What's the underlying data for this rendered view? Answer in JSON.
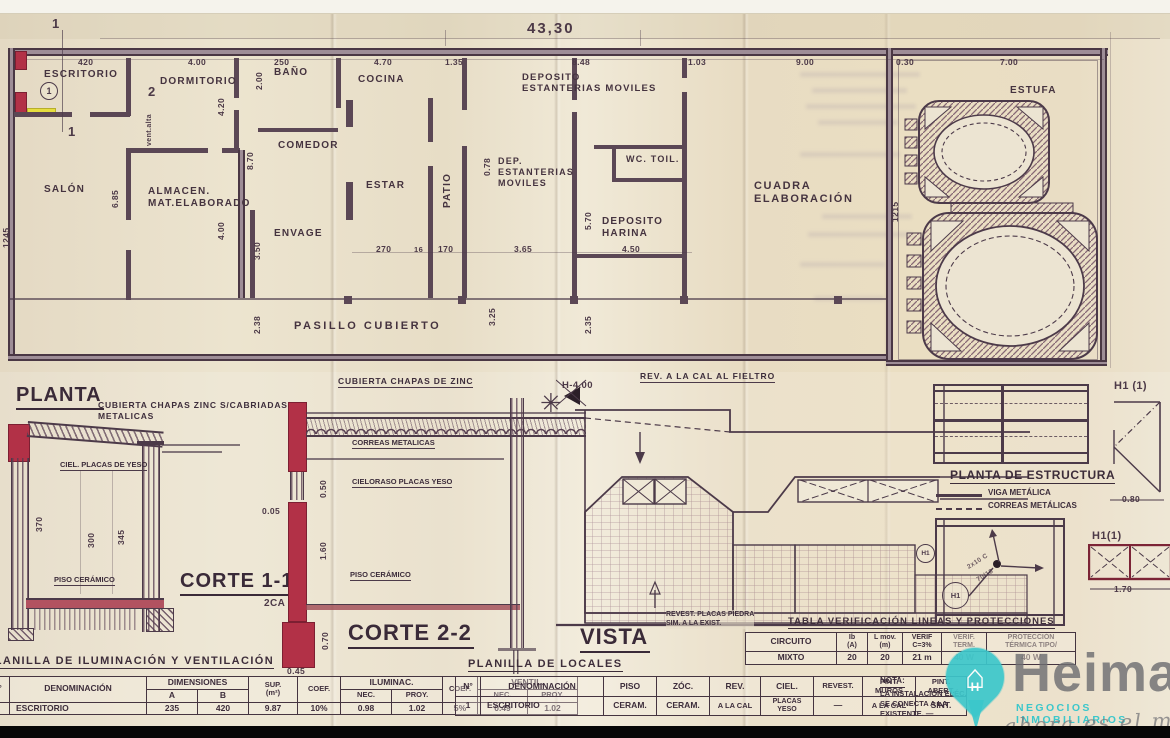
{
  "scan": {
    "overall_width_dim": "43,30"
  },
  "plan": {
    "title": "PLANTA",
    "rooms": {
      "escritorio": "ESCRITORIO",
      "dormitorio": "DORMITORIO",
      "bano": "BAÑO",
      "cocina": "COCINA",
      "salon": "SALÓN",
      "almacen": "ALMACEN.\nMAT.ELABORADO",
      "comedor": "COMEDOR",
      "envage": "ENVAGE",
      "estar": "ESTAR",
      "patio": "PATIO",
      "deposito_estanterias": "DEPOSITO\nESTANTERIAS MOVILES",
      "dep_estanterias": "DEP.\nESTANTERIAS\nMOVILES",
      "wc": "WC.  TOIL.",
      "deposito_harina": "DEPOSITO\nHARINA",
      "cuadra": "CUADRA\nELABORACIÓN",
      "estufa": "ESTUFA",
      "horno_1": "HORNO",
      "horno_2": "HORNO",
      "pasillo": "PASILLO CUBIERTO"
    },
    "dims": {
      "t420": "420",
      "t400": "4.00",
      "t250": "250",
      "t470": "4.70",
      "t135": "1.35",
      "t103": "1.03",
      "t848": "8.48",
      "t900": "9.00",
      "t030": "0.30",
      "t700": "7.00",
      "m270": "270",
      "m16": "16",
      "m170": "170",
      "m365": "3.65",
      "m450": "4.50",
      "v685": "6.85",
      "v420": "4.20",
      "v200": "2.00",
      "v870": "8.70",
      "v400": "4.00",
      "v350": "3.50",
      "v238": "2.38",
      "v078": "0.78",
      "v570": "5.70",
      "v325": "3.25",
      "v235": "2.35",
      "v1215": "1215",
      "v1245": "1245",
      "vent_alta": "vent.alta"
    },
    "marks": {
      "cut1a": "1",
      "cut1b": "1",
      "cut2": "2",
      "circle1": "1"
    }
  },
  "corte1": {
    "title": "CORTE 1-1",
    "cubierta": "CUBIERTA CHAPAS ZINC S/CABRIADAS\nMETALICAS",
    "cielo": "CIEL. PLACAS DE YESO",
    "piso": "PISO CERÁMICO",
    "d370": "370",
    "d300": "300",
    "d345": "345",
    "d005": "0.05",
    "d2ca": "2CA"
  },
  "corte2": {
    "title": "CORTE 2-2",
    "cubierta": "CUBIERTA CHAPAS DE ZINC",
    "correas": "CORREAS METALICAS",
    "cielo": "CIELORASO PLACAS YESO",
    "piso": "PISO CERÁMICO",
    "d050": "0.50",
    "d160": "1.60",
    "d070": "0.70",
    "d045": "0.45"
  },
  "vista": {
    "title": "VISTA",
    "rev": "REV. A LA CAL AL FIELTRO",
    "h": "H-4.00",
    "revest": "REVEST. PLACAS PIEDRA\nSIM. A LA EXIST."
  },
  "estructura": {
    "title": "PLANTA DE ESTRUCTURA",
    "viga": "VIGA METÁLICA",
    "correas": "CORREAS METÁLICAS",
    "h1_top": "H1 (1)",
    "h1_bot": "H1(1)",
    "d080": "0.80",
    "d170": "1.70",
    "h1a": "H1",
    "h1b": "H1",
    "n1": "2x10 C",
    "n2": "70/18"
  },
  "verif": {
    "title": "TABLA VERIFICACIÓN LINEAS Y PROTECCIONES",
    "headers": [
      "CIRCUITO",
      "Ib\n(A)",
      "L mov.\n(m)",
      "VERIF\nC=3%",
      "VERIF.\nTERM.",
      "PROTECCIÓN\nTÉRMICA TIPO/"
    ],
    "row": [
      "MIXTO",
      "20",
      "20",
      "21 m",
      "40 W",
      "40 W"
    ]
  },
  "ilum": {
    "title": "PLANILLA DE ILUMINACIÓN Y VENTILACIÓN",
    "h": {
      "no": "N°",
      "den": "DENOMINACIÓN",
      "dim": "DIMENSIONES",
      "a": "A",
      "b": "B",
      "sup": "SUP.\n(m²)",
      "coef": "COEF.",
      "ilum": "ILUMINAC.",
      "nec": "NEC.",
      "proy": "PROY.",
      "coef2": "COEF.",
      "vent": "VENTIL.",
      "nec2": "NEC.",
      "proy2": "PROY."
    },
    "row": [
      "1",
      "ESCRITORIO",
      "235",
      "420",
      "9.87",
      "10%",
      "0.98",
      "1.02",
      "5%",
      "0.49",
      "1.02"
    ]
  },
  "locales": {
    "title": "PLANILLA DE LOCALES",
    "headers": [
      "N°",
      "DENOMINACIÓN",
      "PISO",
      "ZÓC.",
      "REV.",
      "CIEL.",
      "REVEST.",
      "PINT.\nMUROS",
      "PINT.\nABERT."
    ],
    "row": [
      "1",
      "ESCRITORIO",
      "CERAM.",
      "CERAM.",
      "A LA CAL",
      "PLACAS\nYESO",
      "—",
      "A LA CAL",
      "SINT."
    ]
  },
  "nota": {
    "label": "NOTA:",
    "text": "LA INSTALACIÓN ELÉC.\nSE CONECTA A LA\nEXISTENTE. —"
  },
  "logo": {
    "name": "Heima",
    "subtitle": "NEGOCIOS INMOBILIARIOS",
    "tagline": "ahora es el momento",
    "brand_teal": "#3cc7cb",
    "brand_gray": "#6e6e71"
  }
}
